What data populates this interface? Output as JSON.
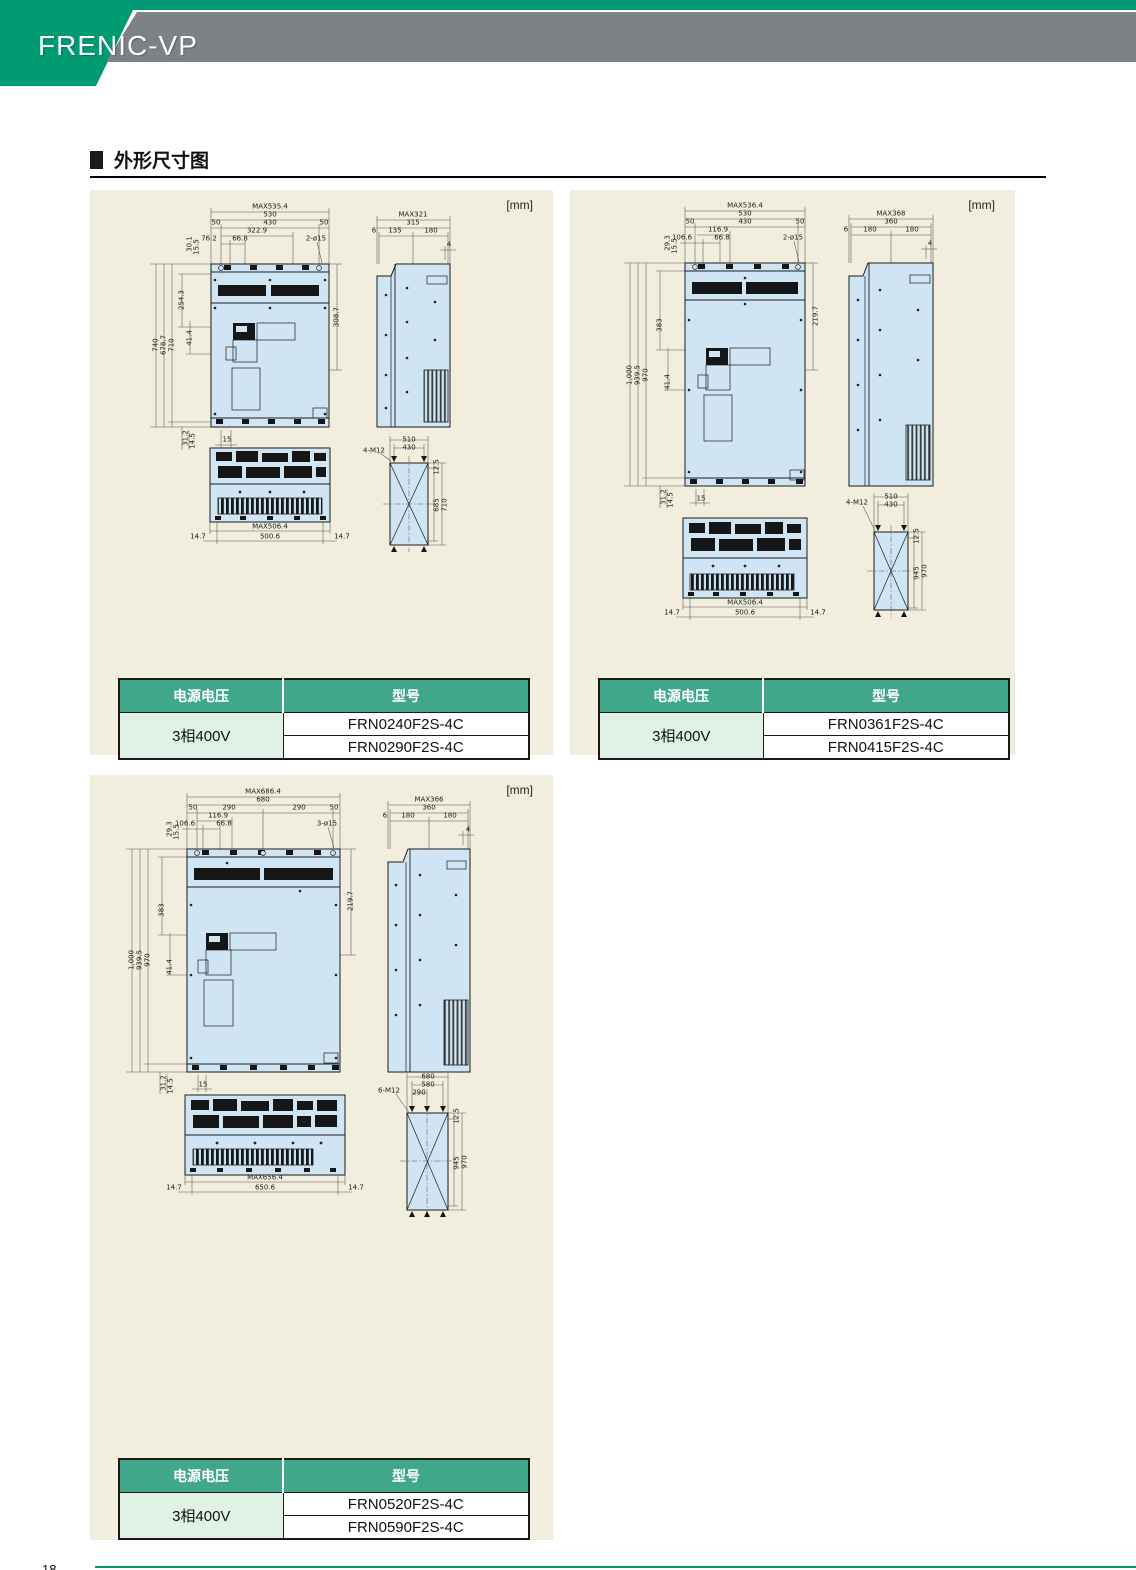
{
  "header": {
    "logo": "FRENIC-VP"
  },
  "section": {
    "title": "外形尺寸图"
  },
  "footer": {
    "page_number": "18"
  },
  "colors": {
    "brand_teal": "#009a73",
    "banner_gray": "#7d8286",
    "table_header": "#40a78b",
    "row_green": "#e0f1e6",
    "panel_bg": "#f1eedd",
    "drawing_blue": "#cfe5f3"
  },
  "panels": [
    {
      "unit": "[mm]",
      "table": {
        "col1": "电源电压",
        "col2": "型号",
        "voltage": "3相400V",
        "models": [
          "FRN0240F2S-4C",
          "FRN0290F2S-4C"
        ]
      },
      "dims": [
        {
          "t": "MAX535.4",
          "x": 180,
          "y": 17
        },
        {
          "t": "530",
          "x": 180,
          "y": 25
        },
        {
          "t": "50",
          "x": 126,
          "y": 33
        },
        {
          "t": "430",
          "x": 180,
          "y": 33
        },
        {
          "t": "50",
          "x": 234,
          "y": 33
        },
        {
          "t": "322.9",
          "x": 167,
          "y": 41
        },
        {
          "t": "76.2",
          "x": 119,
          "y": 49
        },
        {
          "t": "66.8",
          "x": 150,
          "y": 49
        },
        {
          "t": "2-ø15",
          "x": 226,
          "y": 49
        },
        {
          "t": "30.1",
          "x": 100,
          "y": 54,
          "r": 1
        },
        {
          "t": "15.5",
          "x": 107,
          "y": 57,
          "r": 1
        },
        {
          "t": "740",
          "x": 66,
          "y": 155,
          "r": 1
        },
        {
          "t": "678.7",
          "x": 74,
          "y": 155,
          "r": 1
        },
        {
          "t": "710",
          "x": 82,
          "y": 155,
          "r": 1
        },
        {
          "t": "254.3",
          "x": 92,
          "y": 110,
          "r": 1
        },
        {
          "t": "41.4",
          "x": 100,
          "y": 148,
          "r": 1
        },
        {
          "t": "31.2",
          "x": 96,
          "y": 248,
          "r": 1
        },
        {
          "t": "14.5",
          "x": 103,
          "y": 251,
          "r": 1
        },
        {
          "t": "15",
          "x": 137,
          "y": 250
        },
        {
          "t": "308.7",
          "x": 247,
          "y": 127,
          "r": 1
        },
        {
          "t": "MAX321",
          "x": 323,
          "y": 25
        },
        {
          "t": "315",
          "x": 323,
          "y": 33
        },
        {
          "t": "6",
          "x": 284,
          "y": 41
        },
        {
          "t": "135",
          "x": 305,
          "y": 41
        },
        {
          "t": "180",
          "x": 341,
          "y": 41
        },
        {
          "t": "4",
          "x": 359,
          "y": 55
        },
        {
          "t": "MAX506.4",
          "x": 180,
          "y": 337
        },
        {
          "t": "500.6",
          "x": 180,
          "y": 347
        },
        {
          "t": "14.7",
          "x": 108,
          "y": 347
        },
        {
          "t": "14.7",
          "x": 252,
          "y": 347
        },
        {
          "t": "4-M12",
          "x": 284,
          "y": 261
        },
        {
          "t": "510",
          "x": 319,
          "y": 250
        },
        {
          "t": "430",
          "x": 319,
          "y": 258
        },
        {
          "t": "12.5",
          "x": 347,
          "y": 277,
          "r": 1
        },
        {
          "t": "685",
          "x": 347,
          "y": 315,
          "r": 1
        },
        {
          "t": "710",
          "x": 355,
          "y": 315,
          "r": 1
        }
      ]
    },
    {
      "unit": "[mm]",
      "table": {
        "col1": "电源电压",
        "col2": "型号",
        "voltage": "3相400V",
        "models": [
          "FRN0361F2S-4C",
          "FRN0415F2S-4C"
        ]
      },
      "dims": [
        {
          "t": "MAX536.4",
          "x": 175,
          "y": 16
        },
        {
          "t": "530",
          "x": 175,
          "y": 24
        },
        {
          "t": "50",
          "x": 120,
          "y": 32
        },
        {
          "t": "430",
          "x": 175,
          "y": 32
        },
        {
          "t": "50",
          "x": 230,
          "y": 32
        },
        {
          "t": "116.9",
          "x": 148,
          "y": 40
        },
        {
          "t": "106.6",
          "x": 112,
          "y": 48
        },
        {
          "t": "66.8",
          "x": 152,
          "y": 48
        },
        {
          "t": "2-ø15",
          "x": 223,
          "y": 48
        },
        {
          "t": "29.3",
          "x": 98,
          "y": 53,
          "r": 1
        },
        {
          "t": "15.5",
          "x": 105,
          "y": 56,
          "r": 1
        },
        {
          "t": "1,000",
          "x": 60,
          "y": 185,
          "r": 1
        },
        {
          "t": "939.5",
          "x": 68,
          "y": 185,
          "r": 1
        },
        {
          "t": "970",
          "x": 76,
          "y": 185,
          "r": 1
        },
        {
          "t": "383",
          "x": 90,
          "y": 135,
          "r": 1
        },
        {
          "t": "41.4",
          "x": 98,
          "y": 192,
          "r": 1
        },
        {
          "t": "31.2",
          "x": 94,
          "y": 307,
          "r": 1
        },
        {
          "t": "14.5",
          "x": 101,
          "y": 310,
          "r": 1
        },
        {
          "t": "15",
          "x": 131,
          "y": 309
        },
        {
          "t": "219.7",
          "x": 246,
          "y": 126,
          "r": 1
        },
        {
          "t": "MAX368",
          "x": 321,
          "y": 24
        },
        {
          "t": "360",
          "x": 321,
          "y": 32
        },
        {
          "t": "6",
          "x": 276,
          "y": 40
        },
        {
          "t": "180",
          "x": 300,
          "y": 40
        },
        {
          "t": "180",
          "x": 342,
          "y": 40
        },
        {
          "t": "4",
          "x": 360,
          "y": 54
        },
        {
          "t": "MAX506.4",
          "x": 175,
          "y": 413
        },
        {
          "t": "500.6",
          "x": 175,
          "y": 423
        },
        {
          "t": "14.7",
          "x": 102,
          "y": 423
        },
        {
          "t": "14.7",
          "x": 248,
          "y": 423
        },
        {
          "t": "4-M12",
          "x": 287,
          "y": 313
        },
        {
          "t": "510",
          "x": 321,
          "y": 307
        },
        {
          "t": "430",
          "x": 321,
          "y": 315
        },
        {
          "t": "12.5",
          "x": 347,
          "y": 346,
          "r": 1
        },
        {
          "t": "945",
          "x": 347,
          "y": 383,
          "r": 1
        },
        {
          "t": "970",
          "x": 355,
          "y": 381,
          "r": 1
        }
      ]
    },
    {
      "unit": "[mm]",
      "table": {
        "col1": "电源电压",
        "col2": "型号",
        "voltage": "3相400V",
        "models": [
          "FRN0520F2S-4C",
          "FRN0590F2S-4C"
        ]
      },
      "dims": [
        {
          "t": "MAX686.4",
          "x": 173,
          "y": 17
        },
        {
          "t": "680",
          "x": 173,
          "y": 25
        },
        {
          "t": "50",
          "x": 103,
          "y": 33
        },
        {
          "t": "290",
          "x": 139,
          "y": 33
        },
        {
          "t": "290",
          "x": 209,
          "y": 33
        },
        {
          "t": "50",
          "x": 244,
          "y": 33
        },
        {
          "t": "116.9",
          "x": 128,
          "y": 41
        },
        {
          "t": "106.6",
          "x": 95,
          "y": 49
        },
        {
          "t": "66.8",
          "x": 134,
          "y": 49
        },
        {
          "t": "3-ø15",
          "x": 237,
          "y": 49
        },
        {
          "t": "29.3",
          "x": 80,
          "y": 54,
          "r": 1
        },
        {
          "t": "15.5",
          "x": 87,
          "y": 57,
          "r": 1
        },
        {
          "t": "1,000",
          "x": 42,
          "y": 185,
          "r": 1
        },
        {
          "t": "939.5",
          "x": 50,
          "y": 185,
          "r": 1
        },
        {
          "t": "970",
          "x": 58,
          "y": 185,
          "r": 1
        },
        {
          "t": "383",
          "x": 72,
          "y": 135,
          "r": 1
        },
        {
          "t": "41.4",
          "x": 80,
          "y": 192,
          "r": 1
        },
        {
          "t": "31.2",
          "x": 74,
          "y": 308,
          "r": 1
        },
        {
          "t": "14.5",
          "x": 81,
          "y": 311,
          "r": 1
        },
        {
          "t": "15",
          "x": 113,
          "y": 310
        },
        {
          "t": "219.7",
          "x": 261,
          "y": 126,
          "r": 1
        },
        {
          "t": "MAX366",
          "x": 339,
          "y": 25
        },
        {
          "t": "360",
          "x": 339,
          "y": 33
        },
        {
          "t": "6",
          "x": 295,
          "y": 41
        },
        {
          "t": "180",
          "x": 318,
          "y": 41
        },
        {
          "t": "180",
          "x": 360,
          "y": 41
        },
        {
          "t": "4",
          "x": 378,
          "y": 55
        },
        {
          "t": "MAX656.4",
          "x": 175,
          "y": 403
        },
        {
          "t": "650.6",
          "x": 175,
          "y": 413
        },
        {
          "t": "14.7",
          "x": 84,
          "y": 413
        },
        {
          "t": "14.7",
          "x": 266,
          "y": 413
        },
        {
          "t": "6-M12",
          "x": 299,
          "y": 316
        },
        {
          "t": "680",
          "x": 338,
          "y": 302
        },
        {
          "t": "580",
          "x": 338,
          "y": 310
        },
        {
          "t": "290",
          "x": 329,
          "y": 318
        },
        {
          "t": "12.5",
          "x": 367,
          "y": 341,
          "r": 1
        },
        {
          "t": "945",
          "x": 367,
          "y": 388,
          "r": 1
        },
        {
          "t": "970",
          "x": 375,
          "y": 387,
          "r": 1
        }
      ]
    }
  ]
}
